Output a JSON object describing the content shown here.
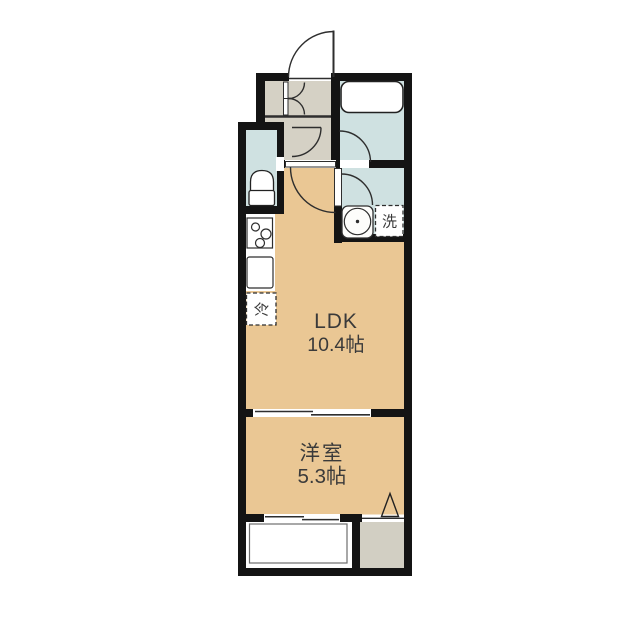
{
  "floorplan": {
    "background": "#ffffff",
    "colors": {
      "wall": "#141414",
      "room_tan": "#eac794",
      "room_blue": "#cfe1e1",
      "room_gray": "#d5d1c5",
      "fixture_white": "#ffffff",
      "line": "#2e2e2e"
    },
    "rooms": {
      "ldk": {
        "name": "LDK",
        "area": "10.4帖"
      },
      "western_room": {
        "name": "洋室",
        "area": "5.3帖"
      }
    },
    "labels": {
      "refrigerator": "冷",
      "washing_machine": "洗"
    },
    "icons": {
      "bathtub": "rounded-rect-tub",
      "toilet": "bowl-and-tank",
      "wash-basin": "circle-with-dot",
      "gas-stove": "three-burner-circles",
      "kitchen-sink": "rect-sink",
      "entrance-door": "quarter-arc-swing",
      "closet-double-doors": "double-quarter-arcs",
      "interior-door": "quarter-arc-swing",
      "sliding-door": "offset-line-segments",
      "window": "offset-line-segments",
      "corner-mark": "outlined-triangle"
    }
  }
}
